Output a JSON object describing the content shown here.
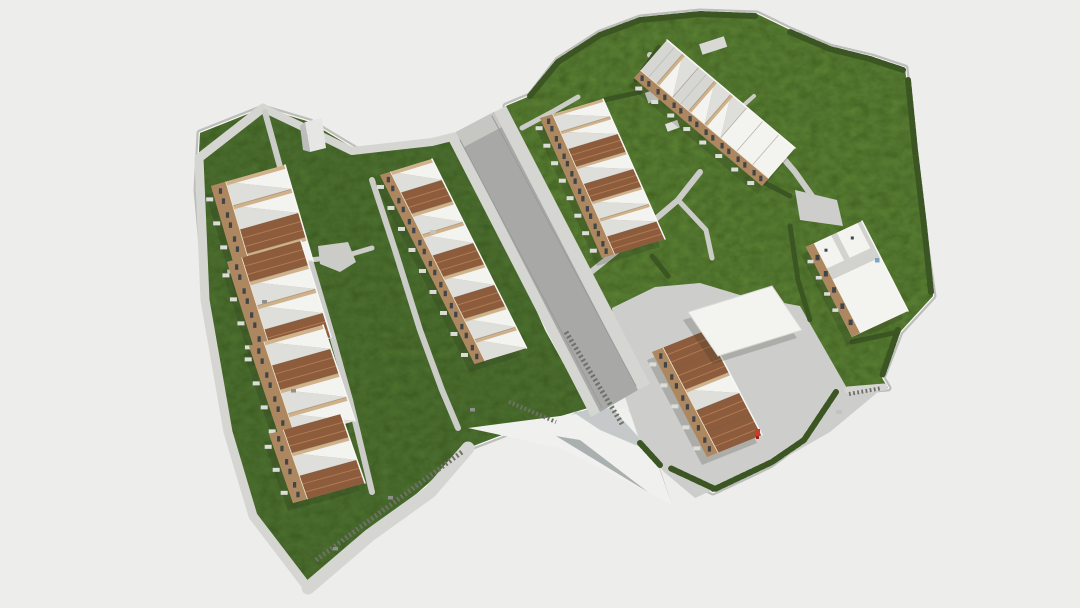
{
  "scene": {
    "kind": "aerial-3d-architectural-render",
    "elements": [
      "site-terrain",
      "main-road",
      "perimeter-walkway",
      "footpaths",
      "terraced-housing-rows",
      "apartment-blocks",
      "lawns",
      "hedges",
      "stairways",
      "plaza",
      "white-canopy",
      "red-marker"
    ],
    "buildings": [
      {
        "name": "terrace-row-west-a",
        "units": 4,
        "pattern": [
          "w",
          "w",
          "t",
          "w"
        ]
      },
      {
        "name": "terrace-row-west-b",
        "units": 4,
        "pattern": [
          "t",
          "w",
          "w",
          "t"
        ]
      },
      {
        "name": "terrace-row-west-c",
        "units": 4,
        "pattern": [
          "w",
          "t",
          "w",
          "w"
        ]
      },
      {
        "name": "terrace-row-west-d",
        "units": 3,
        "pattern": [
          "t",
          "w",
          "t"
        ]
      },
      {
        "name": "terrace-row-center",
        "units": 9,
        "pattern": [
          "w",
          "t",
          "w",
          "w",
          "t",
          "w",
          "t",
          "w",
          "w"
        ]
      },
      {
        "name": "terrace-row-east",
        "units": 8,
        "pattern": [
          "w",
          "w",
          "t",
          "w",
          "t",
          "w",
          "w",
          "t"
        ]
      },
      {
        "name": "apartment-block-north",
        "units": 8,
        "pattern": [
          "g",
          "w",
          "g",
          "w",
          "w",
          "f",
          "f",
          "f"
        ]
      },
      {
        "name": "apartment-block-south",
        "units": 5,
        "pattern": [
          "t",
          "t",
          "w",
          "t",
          "t"
        ]
      },
      {
        "name": "apartment-tower-east",
        "units": 3,
        "pattern": [
          "w",
          "f",
          "f"
        ]
      }
    ],
    "marker": {
      "name": "red-marker",
      "color": "#cf3a2b"
    }
  },
  "palette": {
    "background": "#edeeec",
    "grass": "#507230",
    "grass_bright": "#5c8136",
    "grass_noise": "#2e4a1a",
    "hedge": "#3b5523",
    "road": "#a8a9a6",
    "sidewalk": "#d5d6d2",
    "path": "#cbccc8",
    "plaza": "#cdcecb",
    "wall_rim": "#f7f8f5",
    "wall_gray": "#bdbebb",
    "building_wall": "#c2a27c",
    "building_wall_dark": "#ad875f",
    "gable_end": "#cfb18a",
    "roof_white": "#f3f3f0",
    "roof_shade": "#dededa",
    "roof_gray": "#d6d6d2",
    "terracotta": "#8d5c3d",
    "terracotta_light": "#b07b51",
    "window": "#40454a",
    "balcony": "#dcdcd8",
    "stair": "#6f7168",
    "glass_blue": "#7fa3bf",
    "shadow": "rgba(40,45,30,0.20)",
    "embank_light": "#f0f1ef",
    "embank_mid": "#c6c9c9",
    "embank_dark": "#aab0b0"
  }
}
